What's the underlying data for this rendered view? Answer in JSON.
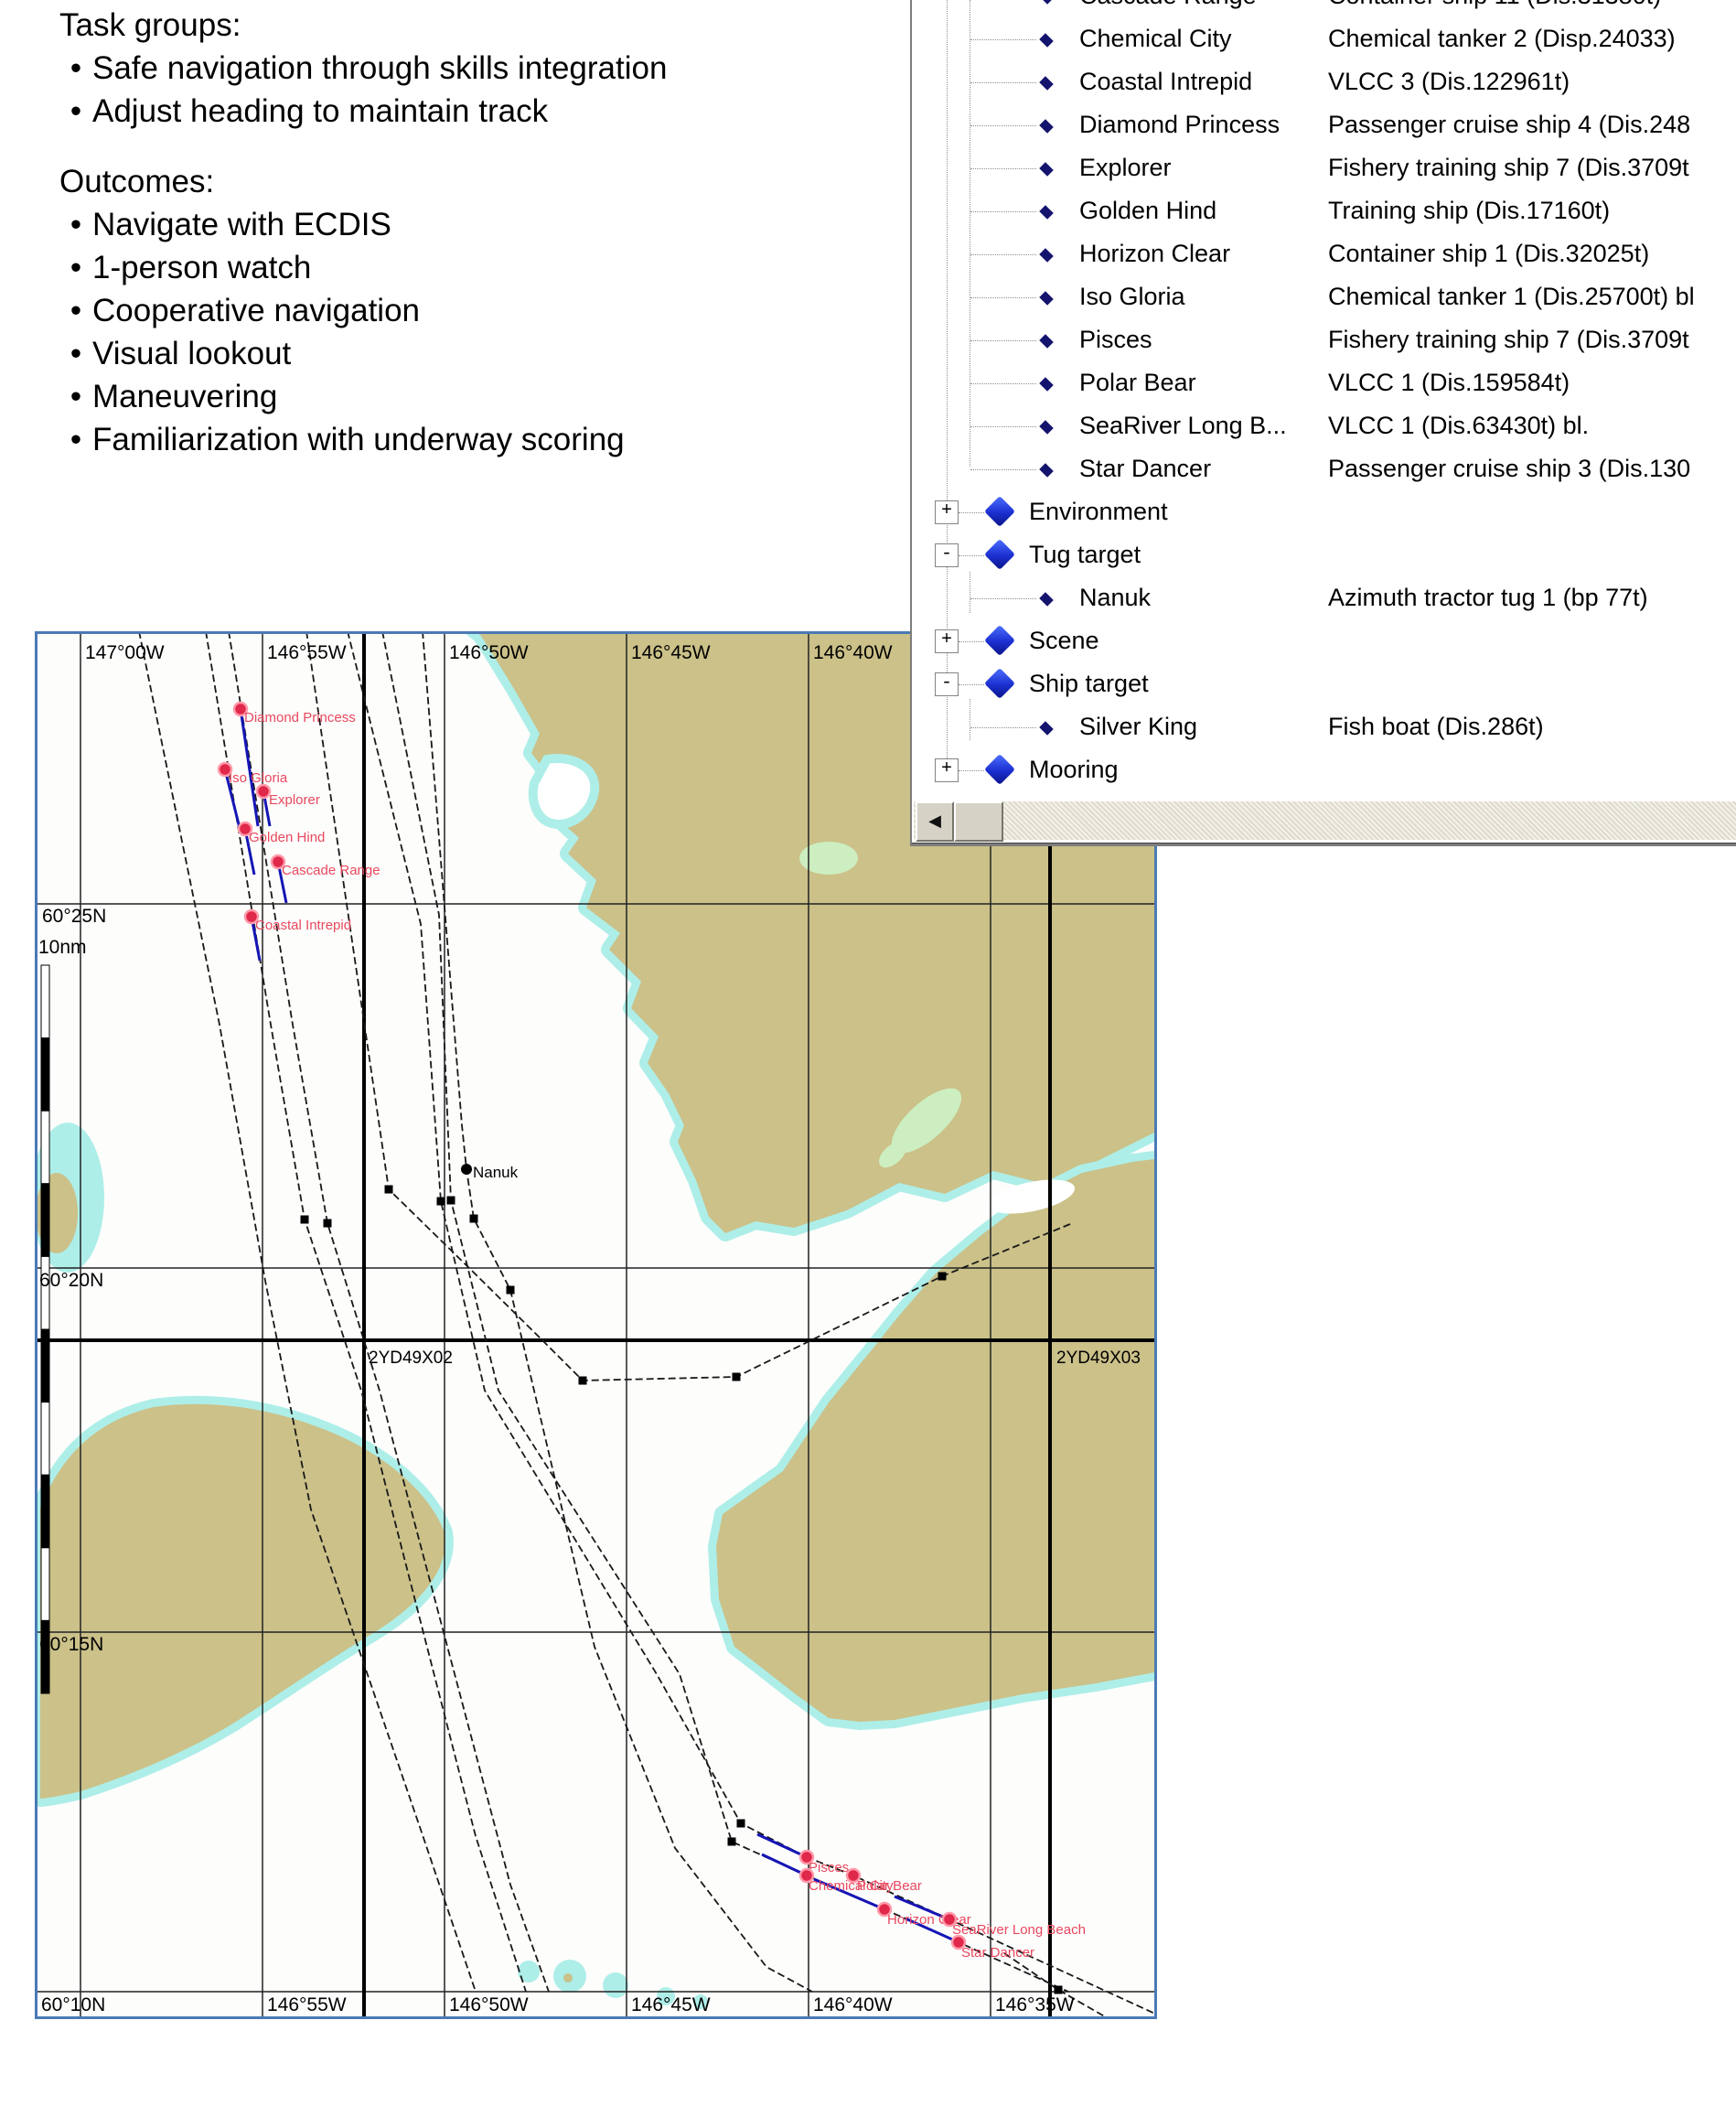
{
  "notes": {
    "task_title": "Task groups:",
    "task_items": [
      "Safe navigation through skills integration",
      "Adjust heading to maintain track"
    ],
    "outcomes_title": "Outcomes:",
    "outcome_items": [
      "Navigate with ECDIS",
      "1-person watch",
      "Cooperative navigation",
      "Visual lookout",
      "Maneuvering",
      "Familiarization with underway scoring"
    ]
  },
  "tree": {
    "rows": [
      {
        "type": "item",
        "name": "Cascade Range",
        "desc": "Container ship 11 (Dis.31380t)"
      },
      {
        "type": "item",
        "name": "Chemical City",
        "desc": "Chemical tanker 2 (Disp.24033)"
      },
      {
        "type": "item",
        "name": "Coastal Intrepid",
        "desc": "VLCC 3 (Dis.122961t)"
      },
      {
        "type": "item",
        "name": "Diamond Princess",
        "desc": "Passenger cruise ship 4 (Dis.248"
      },
      {
        "type": "item",
        "name": "Explorer",
        "desc": "Fishery training ship 7 (Dis.3709t"
      },
      {
        "type": "item",
        "name": "Golden Hind",
        "desc": "Training ship (Dis.17160t)"
      },
      {
        "type": "item",
        "name": "Horizon Clear",
        "desc": "Container ship 1 (Dis.32025t)"
      },
      {
        "type": "item",
        "name": "Iso Gloria",
        "desc": "Chemical tanker 1 (Dis.25700t) bl"
      },
      {
        "type": "item",
        "name": "Pisces",
        "desc": "Fishery training ship 7 (Dis.3709t"
      },
      {
        "type": "item",
        "name": "Polar Bear",
        "desc": "VLCC 1 (Dis.159584t)"
      },
      {
        "type": "item",
        "name": "SeaRiver Long B...",
        "desc": "VLCC 1 (Dis.63430t) bl."
      },
      {
        "type": "item",
        "name": "Star Dancer",
        "desc": "Passenger cruise ship 3 (Dis.130"
      },
      {
        "type": "category",
        "name": "Environment",
        "expander": "+"
      },
      {
        "type": "category",
        "name": "Tug target",
        "expander": "-"
      },
      {
        "type": "item",
        "name": "Nanuk",
        "desc": "Azimuth tractor tug 1 (bp 77t)"
      },
      {
        "type": "category",
        "name": "Scene",
        "expander": "+"
      },
      {
        "type": "category",
        "name": "Ship target",
        "expander": "-"
      },
      {
        "type": "item",
        "name": "Silver King",
        "desc": "Fish boat (Dis.286t)"
      },
      {
        "type": "category",
        "name": "Mooring",
        "expander": "+"
      }
    ],
    "scroll_left_glyph": "◀"
  },
  "map": {
    "top_labels": [
      "147°00W",
      "146°55W",
      "146°50W",
      "146°45W",
      "146°40W"
    ],
    "bottom_labels": [
      "146°55W",
      "146°50W",
      "146°45W",
      "146°40W",
      "146°35W"
    ],
    "lat_labels": [
      "60°25N",
      "60°20N",
      "60°15N"
    ],
    "bottom_left_label": "60°10N",
    "scale_label": "10nm",
    "cell_labels": [
      "2YD49X02",
      "2YD49X03"
    ],
    "ships_red": [
      "Diamond Princess",
      "Iso Gloria",
      "Explorer",
      "Golden Hind",
      "Cascade Range",
      "Coastal Intrepid",
      "Pisces",
      "Chemical City",
      "Polar Bear",
      "Horizon Clear",
      "SeaRiver Long Beach",
      "Star Dancer"
    ],
    "tug_label": "Nanuk",
    "colors": {
      "border": "#4a7ab5",
      "land": "#cbc189",
      "shallow": "#aeeee8",
      "green_patch": "#cdeec0",
      "track": "#191919",
      "trail": "#1515b5",
      "ship_dot": "#e0284a",
      "ship_ring": "#ff9aaa",
      "ship_label": "#e8485e"
    }
  }
}
